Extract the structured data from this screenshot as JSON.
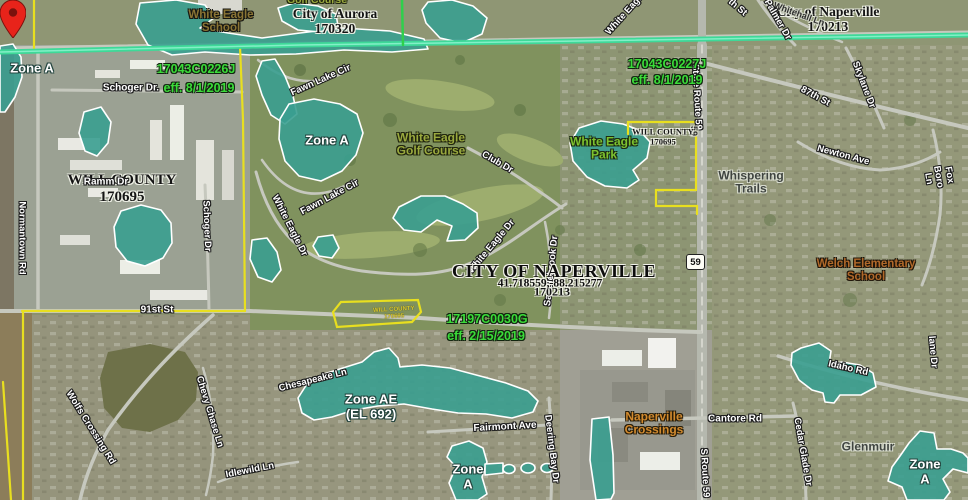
{
  "map": {
    "route_shield": "59",
    "marker": {
      "coordinates": "41.718559,-88.215277"
    },
    "colors": {
      "flood_zone_fill": "#3a9f90",
      "boundary_yellow": "#e8df1f",
      "corporate_line_teal": "#3ed998",
      "panel_line_green": "#2fd04c",
      "panel_text_green": "#3bdc39",
      "pin_red": "#e8231a"
    },
    "labels": [
      {
        "id": "zone-a-left",
        "text": "Zone A",
        "x": 32,
        "y": 69,
        "rot": 0,
        "cls": "zone"
      },
      {
        "id": "white-eagle-school",
        "text": "White Eagle\nSchool",
        "x": 221,
        "y": 22,
        "rot": 0,
        "cls": "place-brown"
      },
      {
        "id": "golf-course-partial",
        "text": "Golf Course",
        "x": 317,
        "y": 1,
        "rot": 0,
        "cls": "place-olive",
        "size": 10.5
      },
      {
        "id": "city-of-aurora",
        "text": "City of Aurora\n170320",
        "x": 335,
        "y": 21,
        "rot": 0,
        "cls": "community",
        "size": 13.5
      },
      {
        "id": "panel-17043C0226J",
        "text": "17043C0226J",
        "x": 196,
        "y": 69,
        "rot": 0,
        "cls": "panel"
      },
      {
        "id": "schoger-dr-top",
        "text": "Schoger Dr.",
        "x": 131,
        "y": 88,
        "rot": 0,
        "cls": "street",
        "size": 10
      },
      {
        "id": "eff-17043C0226J",
        "text": "eff. 8/1/2019",
        "x": 199,
        "y": 88,
        "rot": 0,
        "cls": "panel"
      },
      {
        "id": "city-of-naperville-top",
        "text": "City of Naperville\n170213",
        "x": 828,
        "y": 19,
        "rot": 0,
        "cls": "community",
        "size": 13.5
      },
      {
        "id": "whitehall-ln",
        "text": "Whitehall Ln",
        "x": 799,
        "y": 14,
        "rot": 20,
        "cls": "street-dark",
        "size": 9
      },
      {
        "id": "th-st-partial",
        "text": "th St",
        "x": 737,
        "y": 8,
        "rot": 40,
        "cls": "street"
      },
      {
        "id": "palmer-dr",
        "text": "Palmer Dr",
        "x": 777,
        "y": 20,
        "rot": 60,
        "cls": "street"
      },
      {
        "id": "white-eagle-top-partial",
        "text": "White Eagle",
        "x": 626,
        "y": 14,
        "rot": -48,
        "cls": "street"
      },
      {
        "id": "skylane-dr",
        "text": "Skylane Dr",
        "x": 863,
        "y": 85,
        "rot": 69,
        "cls": "street"
      },
      {
        "id": "87th-st",
        "text": "87th St",
        "x": 815,
        "y": 97,
        "rot": 28,
        "cls": "street"
      },
      {
        "id": "state-route-59",
        "text": "State Route 59",
        "x": 696,
        "y": 97,
        "rot": 87,
        "cls": "street"
      },
      {
        "id": "route-59-pavement",
        "text": "59",
        "x": 694,
        "y": 131,
        "rot": 90,
        "cls": "street-dark",
        "size": 9
      },
      {
        "id": "panel-17043C0227J",
        "text": "17043C0227J",
        "x": 667,
        "y": 64,
        "rot": 0,
        "cls": "panel"
      },
      {
        "id": "eff-17043C0227J",
        "text": "eff. 8/1/2019",
        "x": 667,
        "y": 80,
        "rot": 0,
        "cls": "panel"
      },
      {
        "id": "will-county-park-box",
        "text": "WILL COUNTY\n170695",
        "x": 663,
        "y": 137,
        "rot": 0,
        "cls": "community",
        "size": 8.5
      },
      {
        "id": "white-eagle-park",
        "text": "White Eagle\nPark",
        "x": 604,
        "y": 149,
        "rot": 0,
        "cls": "place-green"
      },
      {
        "id": "newton-ave",
        "text": "Newton Ave",
        "x": 843,
        "y": 156,
        "rot": 15,
        "cls": "street"
      },
      {
        "id": "fox-boro-ln",
        "text": "Fox Boro Ln",
        "x": 938,
        "y": 177,
        "rot": 80,
        "cls": "street"
      },
      {
        "id": "whispering-trails",
        "text": "Whispering\nTrails",
        "x": 751,
        "y": 183,
        "rot": 0,
        "cls": "place-gray"
      },
      {
        "id": "fawn-lake-cir-n",
        "text": "Fawn Lake Cir",
        "x": 321,
        "y": 81,
        "rot": -24,
        "cls": "street"
      },
      {
        "id": "fawn-lake-cir-s",
        "text": "Fawn Lake Cir",
        "x": 330,
        "y": 198,
        "rot": -28,
        "cls": "street"
      },
      {
        "id": "zone-a-lake",
        "text": "Zone A",
        "x": 327,
        "y": 141,
        "rot": 0,
        "cls": "zone"
      },
      {
        "id": "white-eagle-golf-course",
        "text": "White Eagle\nGolf Course",
        "x": 431,
        "y": 145,
        "rot": 0,
        "cls": "place-olive"
      },
      {
        "id": "club-dr",
        "text": "Club Dr",
        "x": 497,
        "y": 163,
        "rot": 30,
        "cls": "street"
      },
      {
        "id": "white-eagle-dr-w",
        "text": "White Eagle Dr",
        "x": 289,
        "y": 226,
        "rot": 63,
        "cls": "street"
      },
      {
        "id": "white-eagle-dr-c",
        "text": "White Eagle Dr",
        "x": 492,
        "y": 247,
        "rot": -50,
        "cls": "street"
      },
      {
        "id": "saddlebrook-dr",
        "text": "Saddlebrook Dr",
        "x": 552,
        "y": 271,
        "rot": -84,
        "cls": "street"
      },
      {
        "id": "will-county-main",
        "text": "WILL COUNTY\n170695",
        "x": 122,
        "y": 189,
        "rot": 0,
        "cls": "community",
        "size": 15
      },
      {
        "id": "ramm-dr",
        "text": "Ramm Dr",
        "x": 106,
        "y": 182,
        "rot": 0,
        "cls": "street",
        "size": 10
      },
      {
        "id": "normantown-rd",
        "text": "Normantown Rd",
        "x": 21,
        "y": 238,
        "rot": 90,
        "cls": "street"
      },
      {
        "id": "schoger-dr-vert",
        "text": "Schoger Dr",
        "x": 206,
        "y": 226,
        "rot": 88,
        "cls": "street"
      },
      {
        "id": "170213-under",
        "text": "170213",
        "x": 552,
        "y": 292,
        "rot": 0,
        "cls": "community",
        "size": 12
      },
      {
        "id": "city-of-naperville-geocode",
        "text": "CITY OF NAPERVILLE",
        "x": 554,
        "y": 271,
        "rot": 0,
        "cls": "geocode-title"
      },
      {
        "id": "geocode-coordinates",
        "text": "41.718559,-88.215277",
        "x": 550,
        "y": 284,
        "rot": 0,
        "cls": "geocode-sub"
      },
      {
        "id": "panel-17197C0030G",
        "text": "17197C0030G",
        "x": 487,
        "y": 319,
        "rot": 0,
        "cls": "panel"
      },
      {
        "id": "eff-17197C0030G",
        "text": "eff. 2/15/2019",
        "x": 486,
        "y": 336,
        "rot": 0,
        "cls": "panel"
      },
      {
        "id": "will-county-small-box",
        "text": "WILL COUNTY\n170695",
        "x": 394,
        "y": 314,
        "rot": -3,
        "cls": "place-yellow"
      },
      {
        "id": "91st-st",
        "text": "91st St",
        "x": 157,
        "y": 310,
        "rot": 0,
        "cls": "street",
        "size": 10
      },
      {
        "id": "wolfs-crossing-rd",
        "text": "Wolfs Crossing Rd",
        "x": 90,
        "y": 428,
        "rot": 58,
        "cls": "street"
      },
      {
        "id": "chevy-chase-ln",
        "text": "Chevy Chase Ln",
        "x": 209,
        "y": 412,
        "rot": 73,
        "cls": "street"
      },
      {
        "id": "idlewild-ln",
        "text": "Idlewild Ln",
        "x": 250,
        "y": 471,
        "rot": -11,
        "cls": "street"
      },
      {
        "id": "chesapeake-ln",
        "text": "Chesapeake Ln",
        "x": 313,
        "y": 381,
        "rot": -14,
        "cls": "street"
      },
      {
        "id": "zone-ae",
        "text": "Zone AE\n(EL 692)",
        "x": 371,
        "y": 407,
        "rot": 0,
        "cls": "zone"
      },
      {
        "id": "fairmont-ave",
        "text": "Fairmont Ave",
        "x": 505,
        "y": 427,
        "rot": -3,
        "cls": "street",
        "size": 10
      },
      {
        "id": "deering-bay-dr",
        "text": "Deering Bay Dr",
        "x": 551,
        "y": 449,
        "rot": 83,
        "cls": "street"
      },
      {
        "id": "zone-a-bottom",
        "text": "Zone\nA",
        "x": 468,
        "y": 477,
        "rot": 0,
        "cls": "zone"
      },
      {
        "id": "naperville-crossings",
        "text": "Naperville\nCrossings",
        "x": 654,
        "y": 424,
        "rot": 0,
        "cls": "place-orange"
      },
      {
        "id": "cantore-rd",
        "text": "Cantore Rd",
        "x": 735,
        "y": 419,
        "rot": 0,
        "cls": "street",
        "size": 10
      },
      {
        "id": "s-route-59",
        "text": "S Route 59",
        "x": 704,
        "y": 473,
        "rot": 87,
        "cls": "street"
      },
      {
        "id": "idaho-rd",
        "text": "Idaho Rd",
        "x": 848,
        "y": 369,
        "rot": 13,
        "cls": "street"
      },
      {
        "id": "cedar-glade-dr",
        "text": "Cedar Glade Dr",
        "x": 802,
        "y": 452,
        "rot": 80,
        "cls": "street"
      },
      {
        "id": "glenmuir",
        "text": "Glenmuir",
        "x": 868,
        "y": 447,
        "rot": 0,
        "cls": "place-gray"
      },
      {
        "id": "zone-a-br",
        "text": "Zone A",
        "x": 925,
        "y": 472,
        "rot": 0,
        "cls": "zone"
      },
      {
        "id": "lane-dr-partial",
        "text": "lane Dr",
        "x": 932,
        "y": 352,
        "rot": 85,
        "cls": "street"
      },
      {
        "id": "welch-elementary",
        "text": "Welch Elementary\nSchool",
        "x": 866,
        "y": 271,
        "rot": 0,
        "cls": "place-orange2"
      }
    ]
  }
}
